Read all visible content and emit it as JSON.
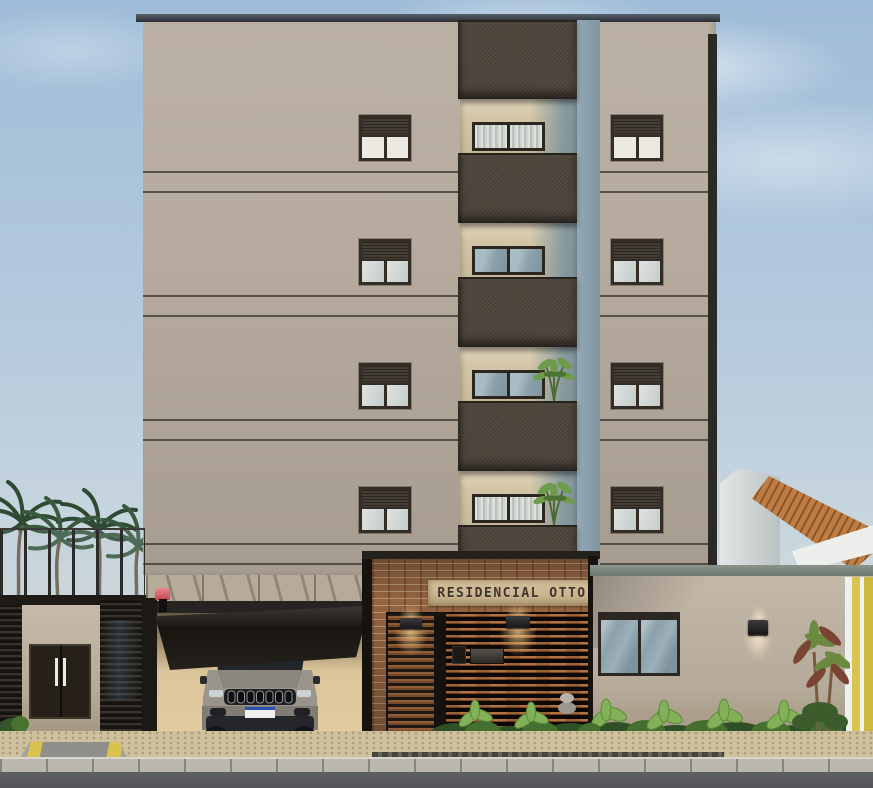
{
  "scene": {
    "description": "Daytime 3D architectural rendering of a five-story residential building facade with street entrance",
    "sign_text": "RESIDENCIAL OTTO"
  },
  "building": {
    "upper_floors": 4,
    "side_window_columns": 2,
    "windows_per_column": 4,
    "central_balcony_stack": 1,
    "balconies_with_plants": 2
  },
  "street_level": {
    "vehicle": "silver-suv-under-carport",
    "entrance_wall_material": "brick-with-wood-slats",
    "entrance_sconces": 2,
    "right_wall_sconce": 1,
    "palm_trees_left": 4,
    "garage_gate_state": "tilted-open",
    "accessibility_ramp": true
  },
  "colors": {
    "sky_top": "#9fbcd8",
    "sky_horizon": "#ccd8de",
    "facade": "#b5aa9d",
    "balcony_panel": "#4e453b",
    "brick": "#9c6a44",
    "sign_band": "#c9b591",
    "sign_text": "#3f342a",
    "roof_tiles": "#bf7d46",
    "neighbor_yellow": "#d9c44e",
    "sidewalk": "#cfc09e",
    "asphalt": "#54565a",
    "warm_light": "#ffd894",
    "foliage": "#4e7c3a"
  }
}
